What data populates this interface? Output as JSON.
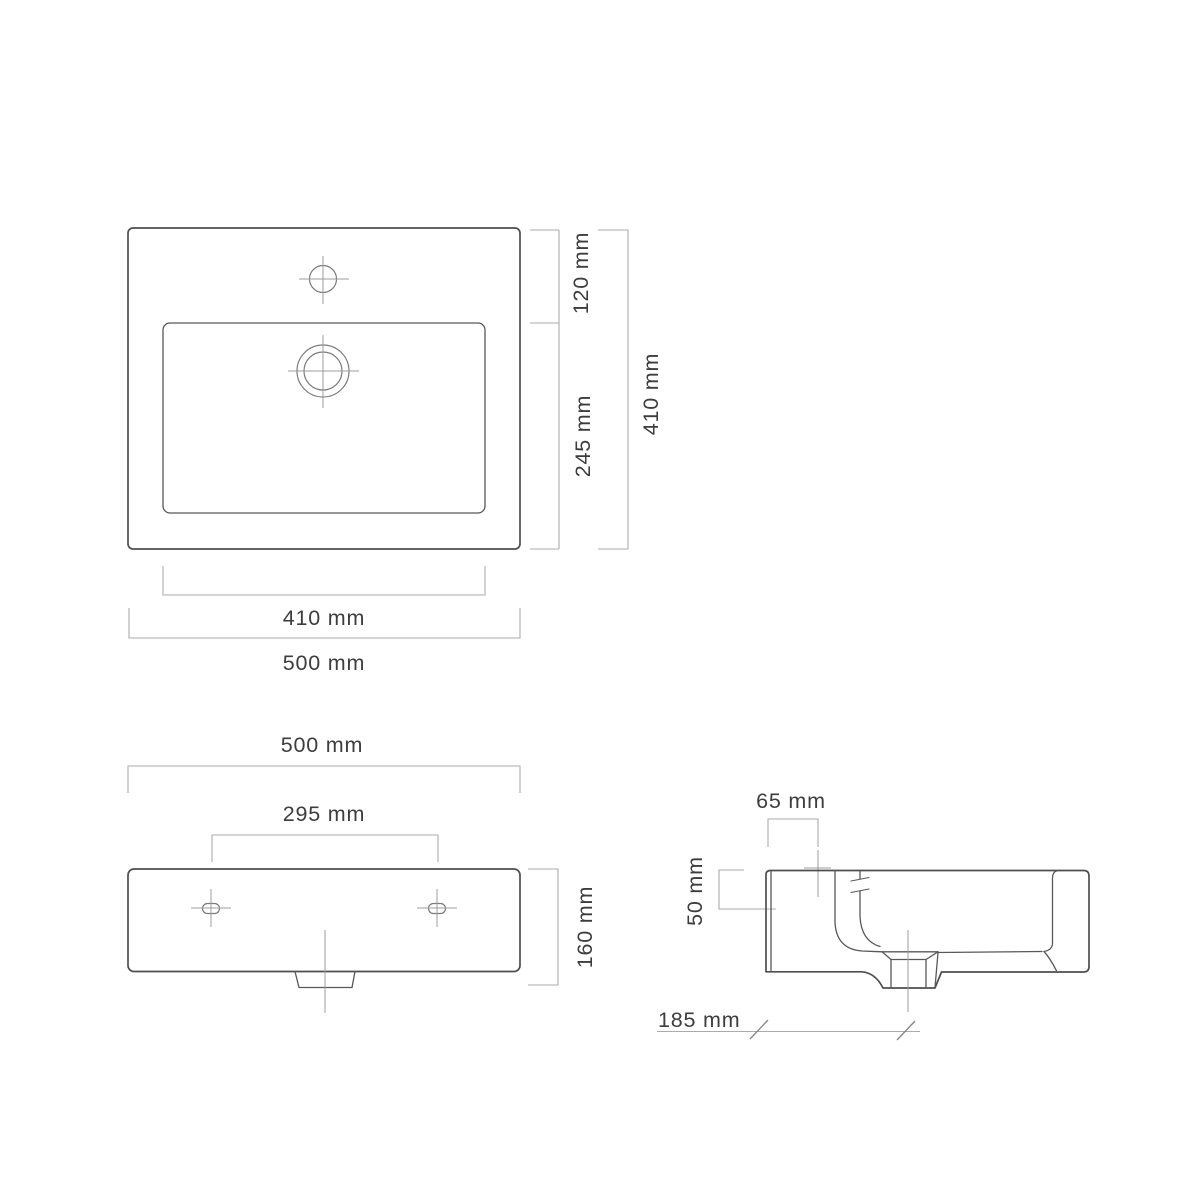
{
  "unit": "mm",
  "colors": {
    "outline": "#4f4f4f",
    "dimension_line": "#ababab",
    "label_text": "#3d3d3d",
    "background": "#ffffff"
  },
  "views": {
    "top": {
      "name": "top-view",
      "depth_back": "120 mm",
      "depth_basin": "245 mm",
      "depth_overall": "410 mm",
      "width_basin": "410 mm",
      "width_overall": "500 mm"
    },
    "front": {
      "name": "front-view",
      "width_overall": "500 mm",
      "hole_spacing": "295 mm",
      "height_overall": "160 mm"
    },
    "side": {
      "name": "side-view",
      "faucet_offset": "65 mm",
      "mount_depth": "50 mm",
      "drain_offset": "185 mm"
    }
  }
}
